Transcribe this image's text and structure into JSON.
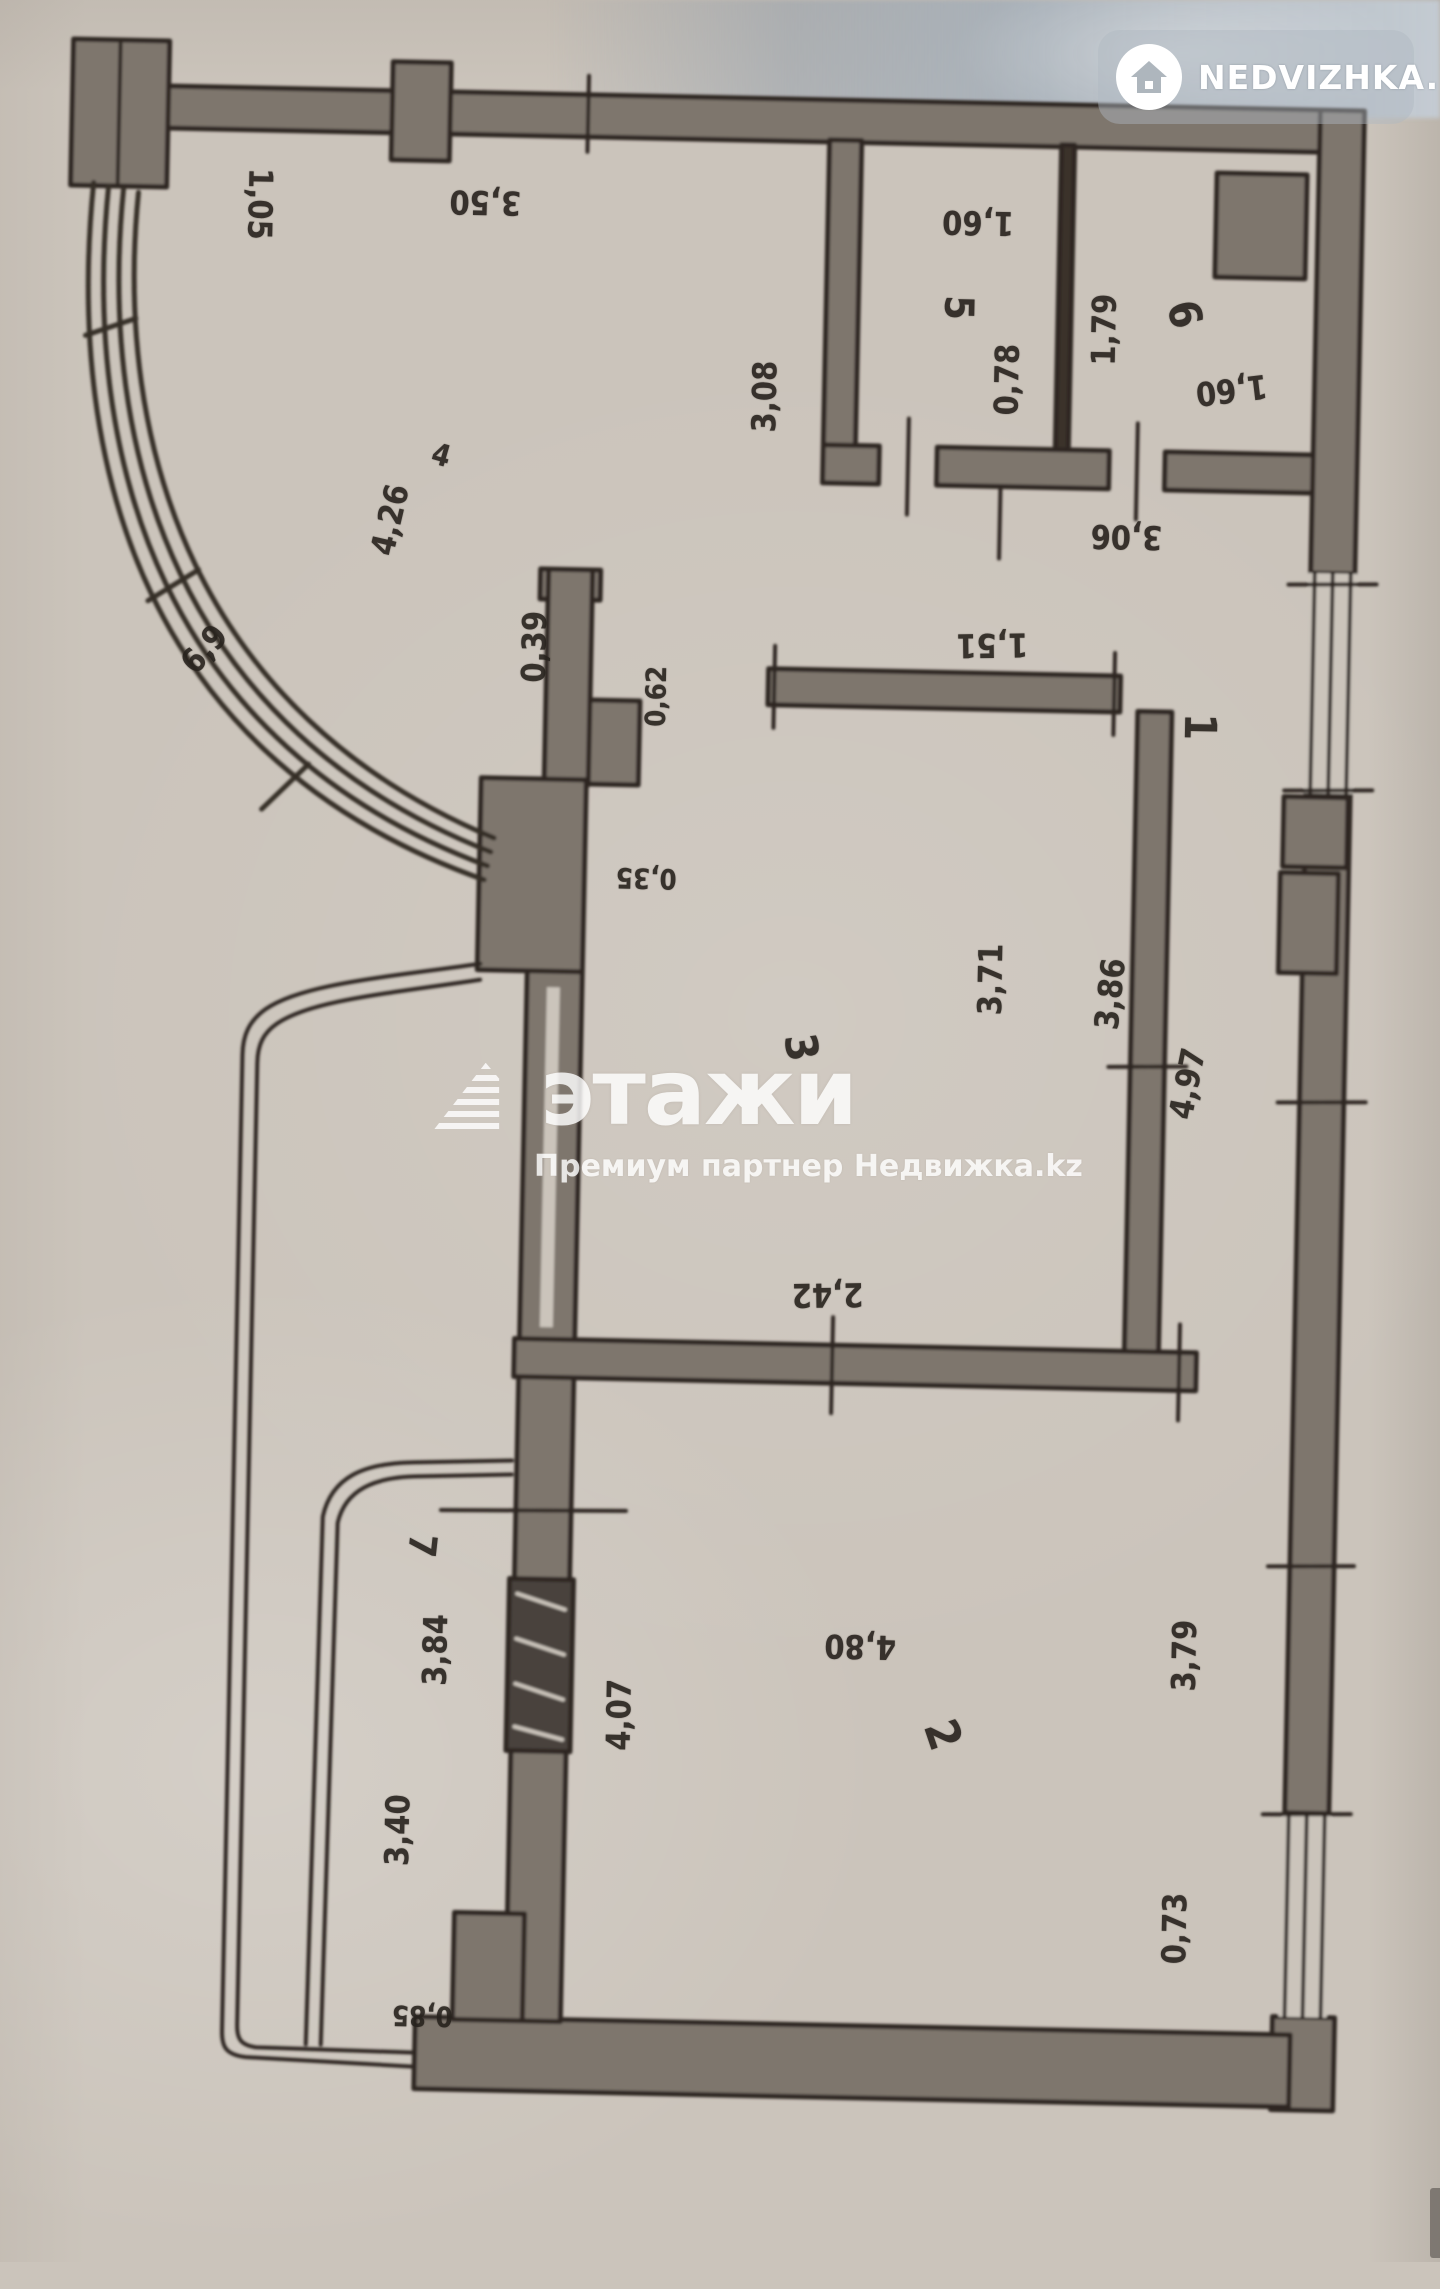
{
  "page_title": "Floor plan photo",
  "logo_badge": {
    "icon": "house-icon",
    "text": "NEDVIZHKA.KZ"
  },
  "watermark": {
    "icon": "etazhi-triangle-logo",
    "brand": "этажи",
    "subtitle": "Премиум партнер Недвижка.kz"
  },
  "colors": {
    "paper": "#cbc4bb",
    "wall_fill": "#7e766d",
    "wall_line": "#2d2722",
    "photo_band_blue": "#97a2ae",
    "watermark_white": "#ffffff"
  },
  "plan": {
    "type": "apartment-floor-plan",
    "labels": [
      {
        "kind": "room",
        "value": "4",
        "x": 448,
        "y": 449,
        "rot": 15,
        "size": 30
      },
      {
        "kind": "room",
        "value": "5",
        "x": 962,
        "y": 290,
        "rot": 90,
        "size": 40
      },
      {
        "kind": "room",
        "value": "6",
        "x": 1188,
        "y": 292,
        "rot": 75,
        "size": 44
      },
      {
        "kind": "room",
        "value": "1",
        "x": 1212,
        "y": 704,
        "rot": 90,
        "size": 44
      },
      {
        "kind": "room",
        "value": "3",
        "x": 820,
        "y": 1033,
        "rot": 80,
        "size": 44
      },
      {
        "kind": "room",
        "value": "2",
        "x": 977,
        "y": 1717,
        "rot": 70,
        "size": 46
      },
      {
        "kind": "room",
        "value": "7",
        "x": 452,
        "y": 1539,
        "rot": 95,
        "size": 38
      },
      {
        "kind": "dim",
        "value": "1,05",
        "x": 262,
        "y": 201,
        "rot": 90
      },
      {
        "kind": "dim",
        "value": "3,50",
        "x": 487,
        "y": 195,
        "rot": 180
      },
      {
        "kind": "dim",
        "value": "3,08",
        "x": 770,
        "y": 383,
        "rot": -90
      },
      {
        "kind": "dim",
        "value": "1,60",
        "x": 980,
        "y": 205,
        "rot": 180
      },
      {
        "kind": "dim",
        "value": "0,78",
        "x": 1012,
        "y": 361,
        "rot": -90
      },
      {
        "kind": "dim",
        "value": "1,79",
        "x": 1108,
        "y": 309,
        "rot": -90
      },
      {
        "kind": "dim",
        "value": "1,60",
        "x": 1237,
        "y": 367,
        "rot": 172
      },
      {
        "kind": "dim",
        "value": "3,06",
        "x": 1135,
        "y": 516,
        "rot": 180
      },
      {
        "kind": "dim",
        "value": "1,51",
        "x": 1003,
        "y": 627,
        "rot": 178
      },
      {
        "kind": "dim",
        "value": "4,26",
        "x": 398,
        "y": 514,
        "rot": -78
      },
      {
        "kind": "dim",
        "value": "6,9",
        "x": 215,
        "y": 647,
        "rot": -50
      },
      {
        "kind": "dim",
        "value": "0,39",
        "x": 545,
        "y": 638,
        "rot": -90
      },
      {
        "kind": "dim",
        "value": "0,62",
        "x": 668,
        "y": 685,
        "rot": -90,
        "size": 28
      },
      {
        "kind": "dim",
        "value": "0,35",
        "x": 662,
        "y": 867,
        "rot": 180,
        "size": 28
      },
      {
        "kind": "dim",
        "value": "3,71",
        "x": 1008,
        "y": 961,
        "rot": -90
      },
      {
        "kind": "dim",
        "value": "3,86",
        "x": 1128,
        "y": 973,
        "rot": -85
      },
      {
        "kind": "dim",
        "value": "4,97",
        "x": 1207,
        "y": 1061,
        "rot": -80
      },
      {
        "kind": "dim",
        "value": "2,42",
        "x": 852,
        "y": 1280,
        "rot": 178
      },
      {
        "kind": "dim",
        "value": "3,84",
        "x": 467,
        "y": 1643,
        "rot": -90
      },
      {
        "kind": "dim",
        "value": "4,07",
        "x": 652,
        "y": 1704,
        "rot": -90
      },
      {
        "kind": "dim",
        "value": "3,40",
        "x": 433,
        "y": 1824,
        "rot": -90
      },
      {
        "kind": "dim",
        "value": "0,85",
        "x": 462,
        "y": 2009,
        "rot": 180,
        "size": 28
      },
      {
        "kind": "dim",
        "value": "4,80",
        "x": 892,
        "y": 1631,
        "rot": 180
      },
      {
        "kind": "dim",
        "value": "3,79",
        "x": 1216,
        "y": 1633,
        "rot": -90
      },
      {
        "kind": "dim",
        "value": "0,73",
        "x": 1212,
        "y": 1906,
        "rot": -90
      }
    ]
  }
}
